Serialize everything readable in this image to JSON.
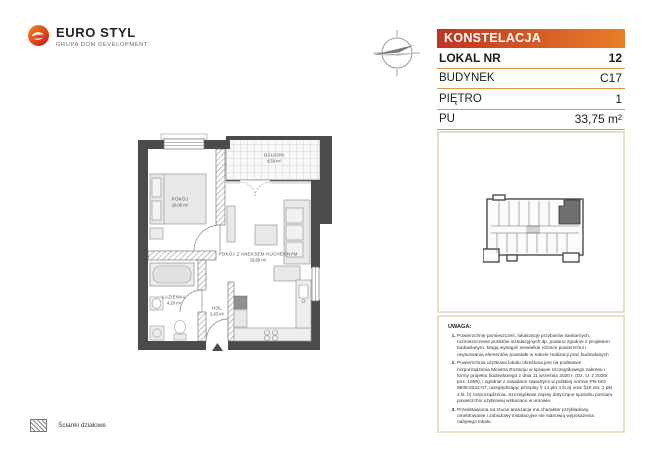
{
  "brand": {
    "name": "EURO STYL",
    "tagline": "GRUPA DOM DEVELOPMENT"
  },
  "unit_card": {
    "project_name": "KONSTELACJA",
    "fields": [
      {
        "label": "LOKAL NR",
        "value": "12"
      },
      {
        "label": "BUDYNEK",
        "value": "C17"
      },
      {
        "label": "PIĘTRO",
        "value": "1"
      },
      {
        "label": "PU",
        "value": "33,75 m²"
      }
    ]
  },
  "floor_plan": {
    "rooms": [
      {
        "name": "POKÓJ",
        "area": "10,06 m²"
      },
      {
        "name": "POKÓJ Z ANEKSEM KUCHENNYM",
        "area": "16,66 m²"
      },
      {
        "name": "ŁAZIENKA",
        "area": "4,20 m²"
      },
      {
        "name": "HOL",
        "area": "2,83 m²"
      },
      {
        "name": "BALKON",
        "area": "4,50 m²"
      }
    ]
  },
  "legend": {
    "partition_walls_label": "Ścianki działowe"
  },
  "notes": {
    "title": "UWAGA:",
    "items": [
      "Powierzchnię pomieszczeń, lokalizację przyborów sanitarnych, rozmieszczenie punktów instalacyjnych itp. podano zgodnie z projektem budowlanym. Mogą wystąpić niewielkie różnice powierzchni i usytuowania elementów powstałe w trakcie realizacji prac budowlanych",
      "Powierzchnia użytkowa lokalu określona jest na podstawie rozporządzenia Ministra Rozwoju w sprawie szczegółowego zakresu i formy projektu budowlanego z dnia 11 września 2020 r. (Dz. U. z 2020r. poz. 1609), i zgodnie z zasadami zawartymi w polskiej normie PN-ISO 9836:2022-07, uwzględniając przepisy § 14 pkt 4 lit.a) oraz §20 ust. 1 pkt 4 lit. b) rozporządzenia. Szczegółowe zapisy dotyczące sposobu pomiaru powierzchni użytkowej wskazano w umowie.",
      "Przedstawiona na rzucie aranżacja ma charakter przykładowy, umeblowanie i zabudowy instalacyjne nie stanowią wyposażenia nabytego lokalu."
    ]
  },
  "colors": {
    "banner_gradient_start": "#bf3424",
    "banner_gradient_end": "#e87e27",
    "box_border": "#e9dfc6",
    "row_divider": "#df9446",
    "wall": "#4b4b4b",
    "highlighted_unit": "#6f6f6f"
  }
}
